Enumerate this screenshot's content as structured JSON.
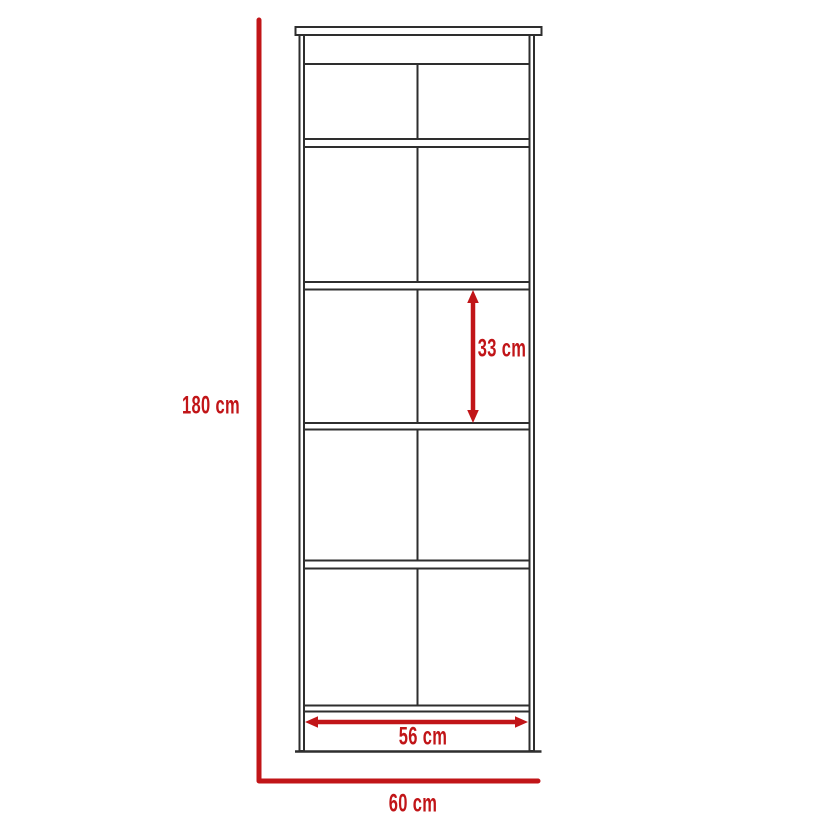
{
  "diagram": {
    "title": "bookcase-dimension-diagram",
    "labels": {
      "height": "180 cm",
      "shelf_spacing": "33 cm",
      "inner_width": "56 cm",
      "outer_width": "60 cm"
    },
    "values": {
      "height_cm": 180,
      "shelf_spacing_cm": 33,
      "inner_width_cm": 56,
      "outer_width_cm": 60
    },
    "structure": {
      "shelf_rows": 5,
      "columns_per_row": 2,
      "top_rail": 1
    },
    "colors": {
      "dimension_red": "#c11518",
      "outline_dark": "#2e2e2e",
      "background": "#ffffff"
    }
  }
}
